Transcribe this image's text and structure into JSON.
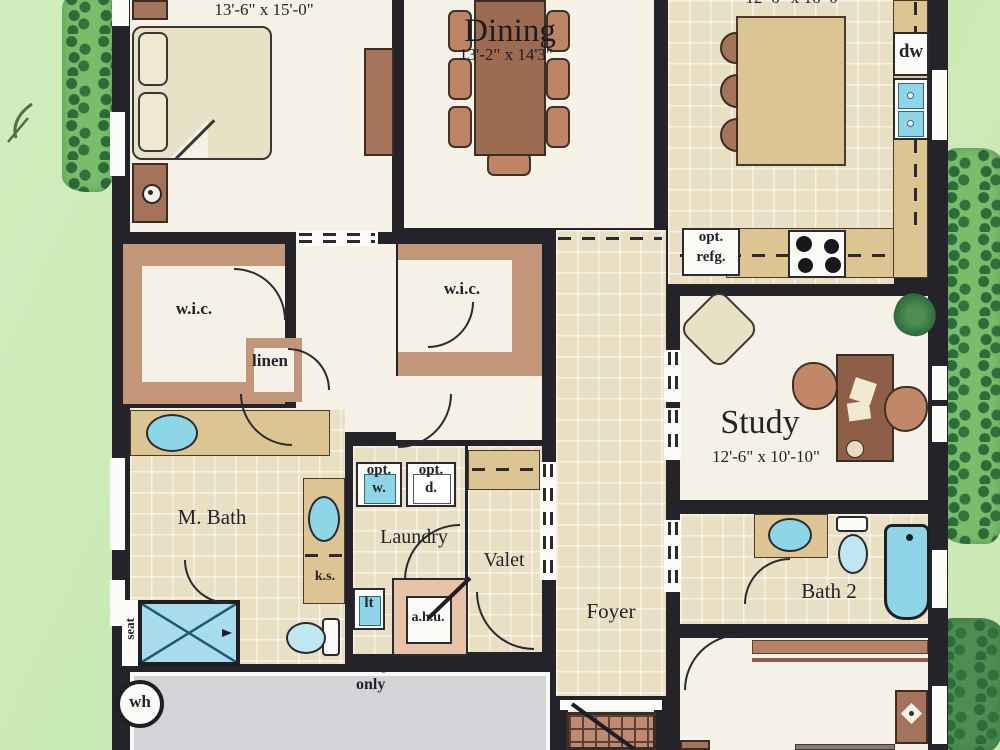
{
  "rooms": {
    "master_bedroom": {
      "dims": "13'-6\" x 15'-0\""
    },
    "dining": {
      "name": "Dining",
      "dims": "13'-2\" x 14'3\""
    },
    "kitchen": {
      "dims": "12'-6\" x 16'-0\""
    },
    "wic_left": {
      "name": "w.i.c."
    },
    "wic_center": {
      "name": "w.i.c."
    },
    "linen": {
      "name": "linen"
    },
    "master_bath": {
      "name": "M. Bath"
    },
    "laundry": {
      "name": "Laundry"
    },
    "valet": {
      "name": "Valet"
    },
    "foyer": {
      "name": "Foyer"
    },
    "study": {
      "name": "Study",
      "dims": "12'-6\" x 10'-10\""
    },
    "bath2": {
      "name": "Bath 2"
    }
  },
  "labels": {
    "dw": "dw",
    "opt_refg": [
      "opt.",
      "refg."
    ],
    "opt_w": [
      "opt.",
      "w."
    ],
    "opt_d": [
      "opt.",
      "d."
    ],
    "ks": "k.s.",
    "lt": "lt",
    "ahu": "a.h.u.",
    "seat": "seat",
    "wh": "wh",
    "rough_in": [
      "rough-in",
      "only"
    ]
  },
  "colors": {
    "lawn": "#cce9b5",
    "hedge": "#79bd6b",
    "wall": "#24232a",
    "room_floor": "#f5f1e6",
    "tile_floor": "#e9dfc3",
    "wood": "#a5725a",
    "counter": "#dcc593",
    "fixture_blue": "#8fd5e8",
    "garage_floor": "#d2d4d7"
  }
}
